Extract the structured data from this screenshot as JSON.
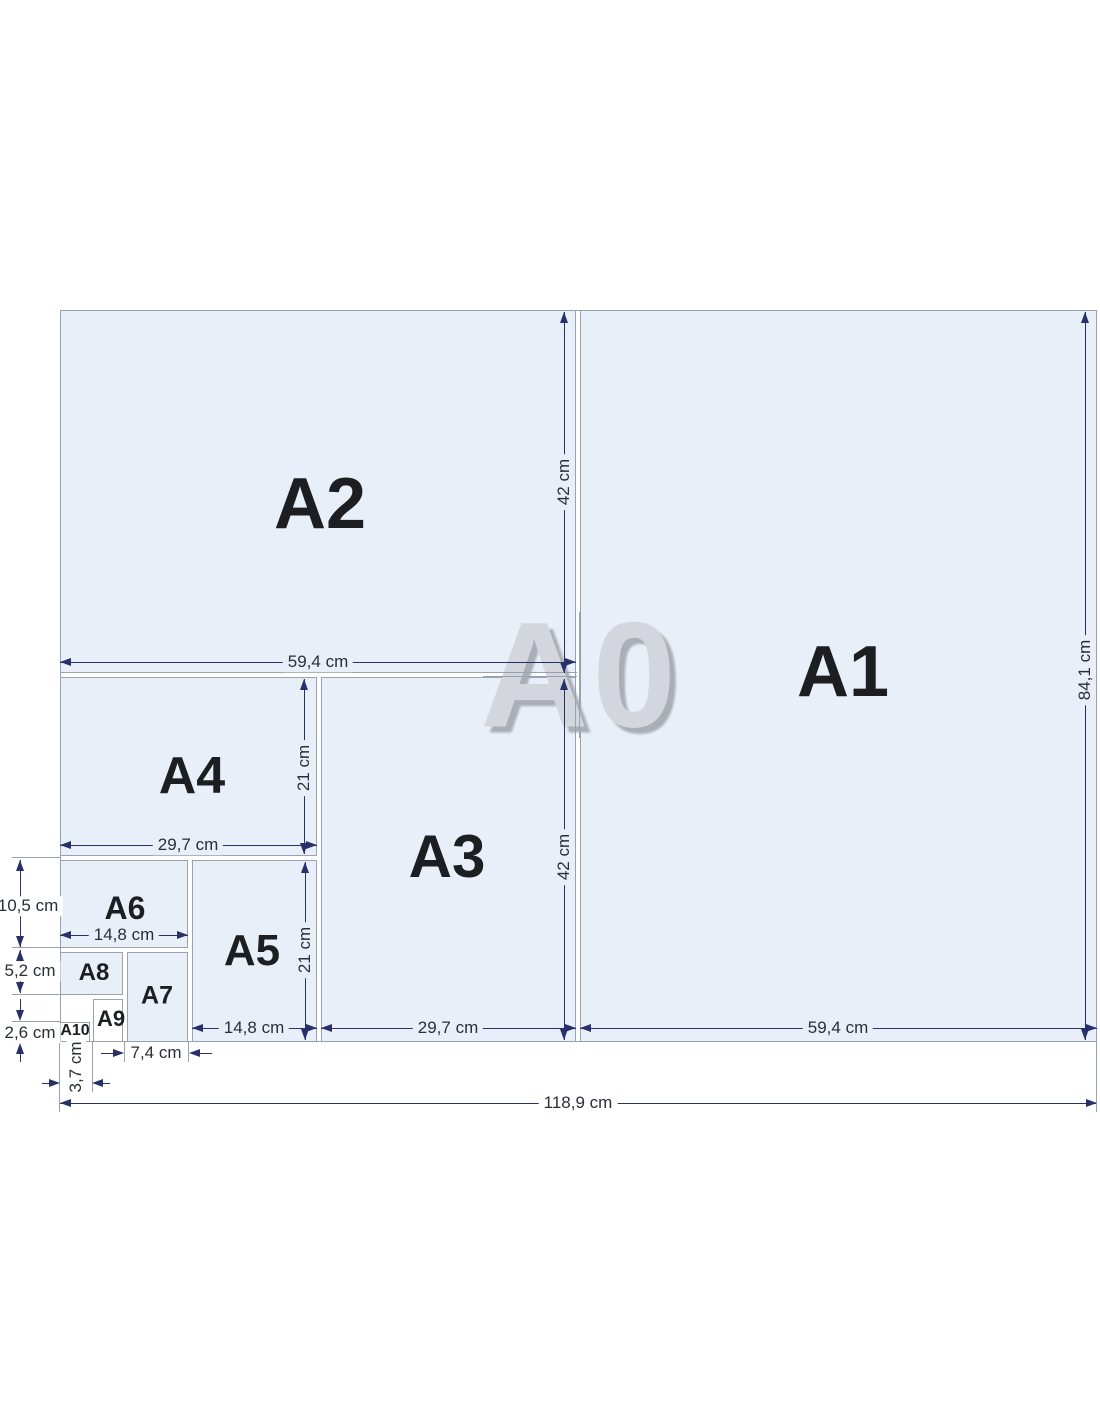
{
  "diagram": {
    "watermark": "A0",
    "papers": {
      "a1": "A1",
      "a2": "A2",
      "a3": "A3",
      "a4": "A4",
      "a5": "A5",
      "a6": "A6",
      "a7": "A7",
      "a8": "A8",
      "a9": "A9",
      "a10": "A10"
    },
    "dimensions": {
      "a2_width": "59,4 cm",
      "a2_height": "42 cm",
      "a4_width": "29,7 cm",
      "a4_height": "21 cm",
      "a6_width": "14,8 cm",
      "a6_height": "10,5 cm",
      "a8_height": "5,2 cm",
      "a10_height": "2,6 cm",
      "a10_width": "3,7 cm",
      "a7_width": "7,4 cm",
      "a5_width": "14,8 cm",
      "a5_height": "21 cm",
      "a3_width": "29,7 cm",
      "a3_height": "42 cm",
      "a1_width": "59,4 cm",
      "a1_height": "84,1 cm",
      "a0_width": "118,9 cm"
    },
    "colors": {
      "paper_fill": "#e9eff9",
      "paper_fill_small": "#ffffff",
      "paper_edge": "#9aa2af",
      "dimension_line": "#27306b",
      "dimension_text": "#2a2e36",
      "label_text": "#1c1e22",
      "watermark_fill": "#d3d6dc",
      "watermark_shadow": "#a9aeb7",
      "background": "#ffffff"
    }
  }
}
